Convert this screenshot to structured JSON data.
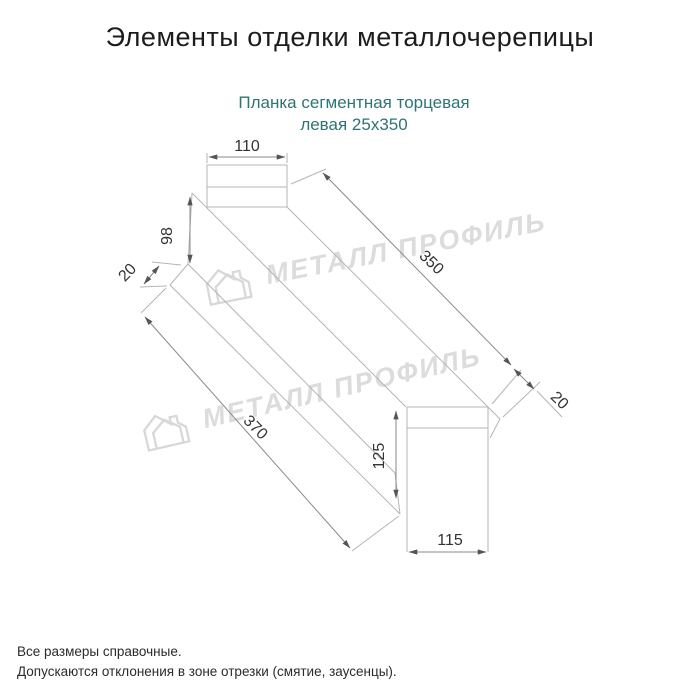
{
  "page": {
    "title": "Элементы отделки металлочерепицы",
    "background_color": "#ffffff"
  },
  "product": {
    "name_line1": "Планка сегментная торцевая",
    "name_line2": "левая 25х350",
    "accent_color": "#2e7474"
  },
  "drawing": {
    "type": "isometric-technical-drawing",
    "line_color": "#b5b5b5",
    "dimension_color": "#333333",
    "dimensions": {
      "top_width": "110",
      "left_face_height": "98",
      "left_flange": "20",
      "length_top": "350",
      "length_bottom": "370",
      "right_face_height": "125",
      "bottom_width": "115",
      "right_flange": "20"
    }
  },
  "watermark": {
    "text": "МЕТАЛЛ ПРОФИЛЬ",
    "logo_icon": "house-logo",
    "color": "#dcdcdc"
  },
  "notes": {
    "line1": "Все размеры справочные.",
    "line2": "Допускаются отклонения в зоне отрезки (смятие, заусенцы)."
  }
}
